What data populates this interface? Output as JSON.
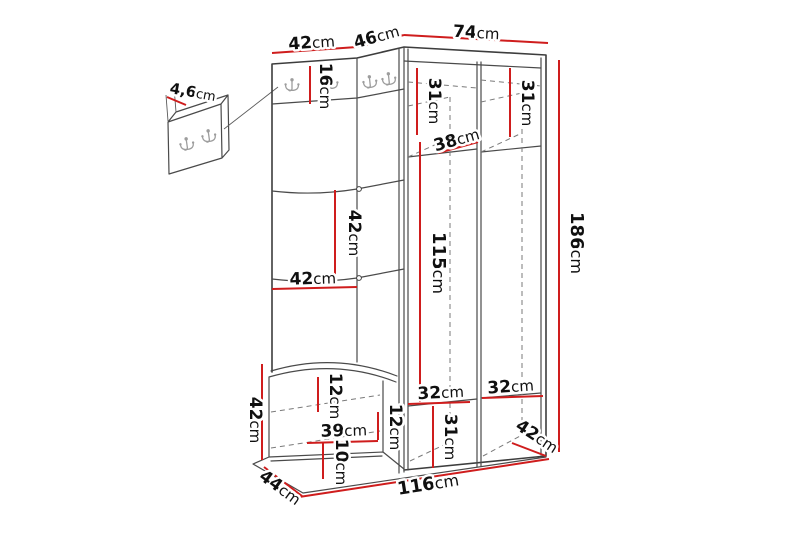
{
  "diagram": {
    "kind": "hallway-furniture-dimension-drawing",
    "unit": "cm",
    "colors": {
      "dimension_line": "#cf1d1d",
      "outline": "#3d3d3d",
      "hidden_edge": "#7a7a7a",
      "hook": "#9d9d9d",
      "background": "#ffffff"
    },
    "hooks": {
      "main_unit_count": 4,
      "wall_panel_count": 2
    },
    "dims": {
      "top_left_42": {
        "value": "42",
        "unit": "cm"
      },
      "top_corner_46": {
        "value": "46",
        "unit": "cm"
      },
      "top_right_74": {
        "value": "74",
        "unit": "cm"
      },
      "wall_panel_4_6": {
        "value": "4,6",
        "unit": "cm"
      },
      "hook_panel_16": {
        "value": "16",
        "unit": "cm"
      },
      "upper_left_31": {
        "value": "31",
        "unit": "cm"
      },
      "upper_right_31": {
        "value": "31",
        "unit": "cm"
      },
      "shelf_38": {
        "value": "38",
        "unit": "cm"
      },
      "panel_v_42": {
        "value": "42",
        "unit": "cm"
      },
      "panel_h_42": {
        "value": "42",
        "unit": "cm"
      },
      "door_115": {
        "value": "115",
        "unit": "cm"
      },
      "height_186": {
        "value": "186",
        "unit": "cm"
      },
      "bench_h_42": {
        "value": "42",
        "unit": "cm"
      },
      "bench_top_12": {
        "value": "12",
        "unit": "cm"
      },
      "bench_39": {
        "value": "39",
        "unit": "cm"
      },
      "bench_right_12": {
        "value": "12",
        "unit": "cm"
      },
      "plinth_10": {
        "value": "10",
        "unit": "cm"
      },
      "bench_depth_44": {
        "value": "44",
        "unit": "cm"
      },
      "shelf_left_32": {
        "value": "32",
        "unit": "cm"
      },
      "shelf_right_32": {
        "value": "32",
        "unit": "cm"
      },
      "bottom_31": {
        "value": "31",
        "unit": "cm"
      },
      "right_depth_42": {
        "value": "42",
        "unit": "cm"
      },
      "width_116": {
        "value": "116",
        "unit": "cm"
      }
    }
  }
}
